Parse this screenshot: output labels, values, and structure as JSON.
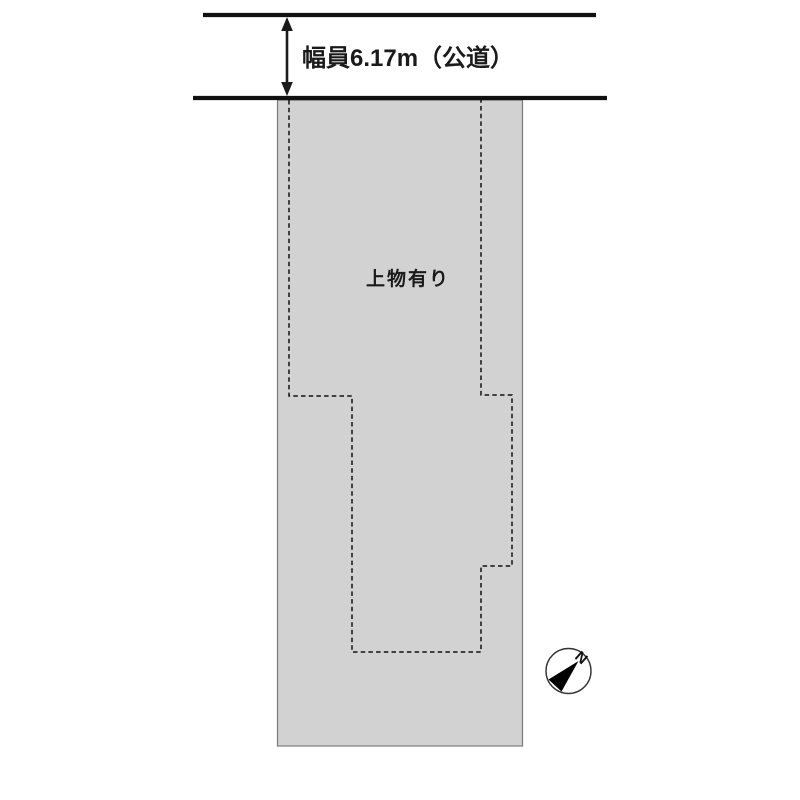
{
  "road": {
    "width_label": "幅員6.17m（公道）"
  },
  "parcel": {
    "building_label": "上物有り"
  },
  "compass": {
    "north_label": "N"
  },
  "colors": {
    "parcel_fill": "#d2d2d2",
    "parcel_border": "#7a7a7a",
    "line_black": "#111111",
    "text": "#1a1a1a"
  }
}
